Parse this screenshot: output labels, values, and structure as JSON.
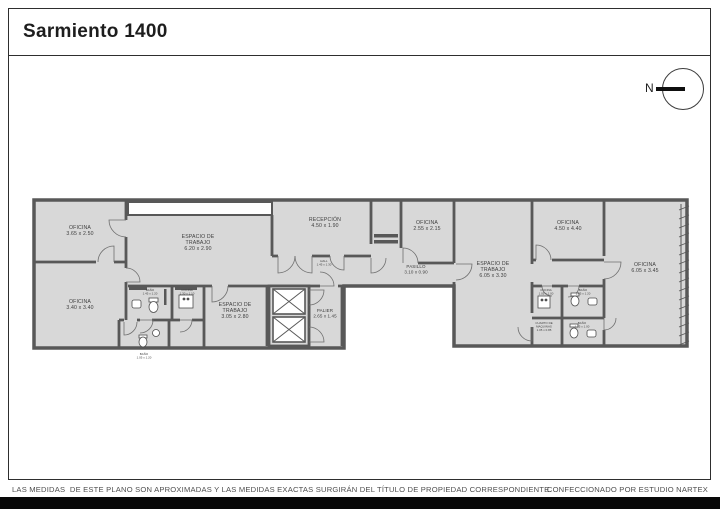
{
  "window": {
    "title": "Sarmiento 1400"
  },
  "compass": {
    "label": "N"
  },
  "footer": {
    "disclaimer": "LAS MEDIDAS  DE ESTE PLANO SON APROXIMADAS Y LAS MEDIDAS EXACTAS SURGIRÁN DEL TÍTULO DE PROPIEDAD CORRESPONDIENTE.",
    "credit": "CONFECCIONADO POR ESTUDIO NARTEX"
  },
  "plan": {
    "colors": {
      "floor": "#d8d8d8",
      "wall": "#585858"
    },
    "rooms": {
      "oficina_a": {
        "name": "OFICINA",
        "dims": "3.65 x 2.50"
      },
      "oficina_b": {
        "name": "OFICINA",
        "dims": "3.40 x 3.40"
      },
      "espacio_a": {
        "l1": "ESPACIO DE",
        "l2": "TRABAJO",
        "dims": "6.20 x 2.90"
      },
      "bano_a": {
        "name": "BAÑO",
        "dims": "1.45 x 1.20"
      },
      "cocina_a": {
        "name": "COCINA",
        "dims": "1.30 x 1.10"
      },
      "bano_b": {
        "name": "BAÑO",
        "dims": "1.05 x 1.20"
      },
      "espacio_b": {
        "l1": "ESPACIO DE",
        "l2": "TRABAJO",
        "dims": "3.05 x 2.80"
      },
      "palier": {
        "name": "PALIER",
        "dims": "2.65 x 1.45"
      },
      "recepcion": {
        "name": "RECEPCIÓN",
        "dims": "4.50 x 1.90"
      },
      "hall": {
        "name": "HALL",
        "dims": "1.45 x 1.30"
      },
      "oficina_c": {
        "name": "OFICINA",
        "dims": "2.55 x 2.15"
      },
      "pasillo": {
        "name": "PASILLO",
        "dims": "3.10 x 0.90"
      },
      "espacio_c": {
        "l1": "ESPACIO DE",
        "l2": "TRABAJO",
        "dims": "6.05 x 3.30"
      },
      "oficina_d": {
        "name": "OFICINA",
        "dims": "4.50 x 4.40"
      },
      "oficina_e": {
        "name": "OFICINA",
        "dims": "6.05 x 3.45"
      },
      "cocina_b": {
        "name": "COCINA",
        "dims": "1.05 x 1.00"
      },
      "bano_c": {
        "name": "BAÑO",
        "dims": "1.65 x 1.20"
      },
      "cuarto_maquinas": {
        "l1": "CUARTO DE",
        "l2": "MAQUINAS",
        "dims": "1.05 x 0.85"
      },
      "bano_d": {
        "name": "BAÑO",
        "dims": "1.25 x 1.00"
      }
    }
  }
}
